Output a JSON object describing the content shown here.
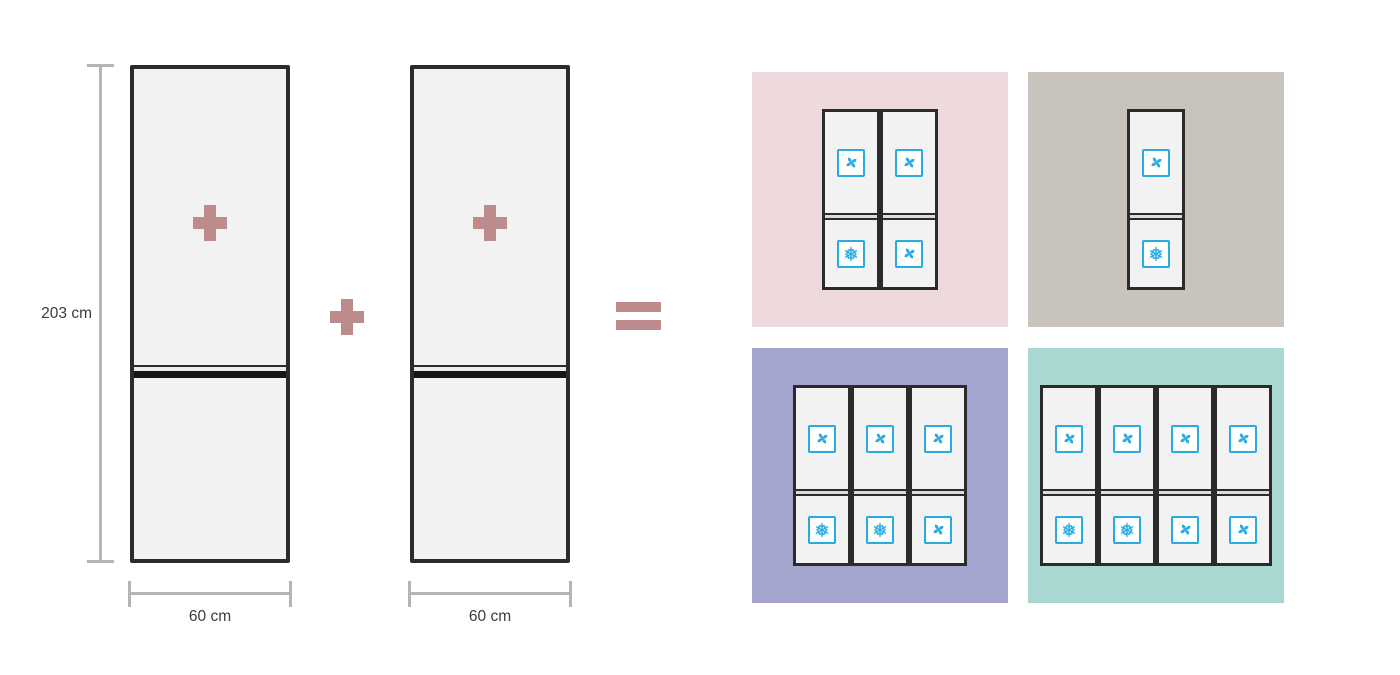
{
  "dimensions": {
    "height_label": "203 cm",
    "fridge1_width_label": "60 cm",
    "fridge2_width_label": "60 cm"
  },
  "operators": {
    "inside_fridge_1": "plus",
    "inside_fridge_2": "plus",
    "between_fridges": "plus",
    "result": "equals"
  },
  "colors": {
    "operator": "#bd8b8b",
    "fridge_fill": "#f2f2f2",
    "fridge_border": "#2b2b2b",
    "icon_blue": "#29abe2",
    "dimension_line": "#b5b5b5",
    "label_text": "#3c3c3c"
  },
  "panels": [
    {
      "id": "pink",
      "color": "#eed9dc",
      "columns": [
        {
          "top": "fan",
          "bottom": "snowflake"
        },
        {
          "top": "fan",
          "bottom": "fan"
        }
      ]
    },
    {
      "id": "taupe",
      "color": "#c9c3bd",
      "columns": [
        {
          "top": "fan",
          "bottom": "snowflake"
        }
      ]
    },
    {
      "id": "purple",
      "color": "#a3a5ce",
      "columns": [
        {
          "top": "fan",
          "bottom": "snowflake"
        },
        {
          "top": "fan",
          "bottom": "snowflake"
        },
        {
          "top": "fan",
          "bottom": "fan"
        }
      ]
    },
    {
      "id": "teal",
      "color": "#a9d7d2",
      "columns": [
        {
          "top": "fan",
          "bottom": "snowflake"
        },
        {
          "top": "fan",
          "bottom": "snowflake"
        },
        {
          "top": "fan",
          "bottom": "fan"
        },
        {
          "top": "fan",
          "bottom": "fan"
        }
      ]
    }
  ]
}
